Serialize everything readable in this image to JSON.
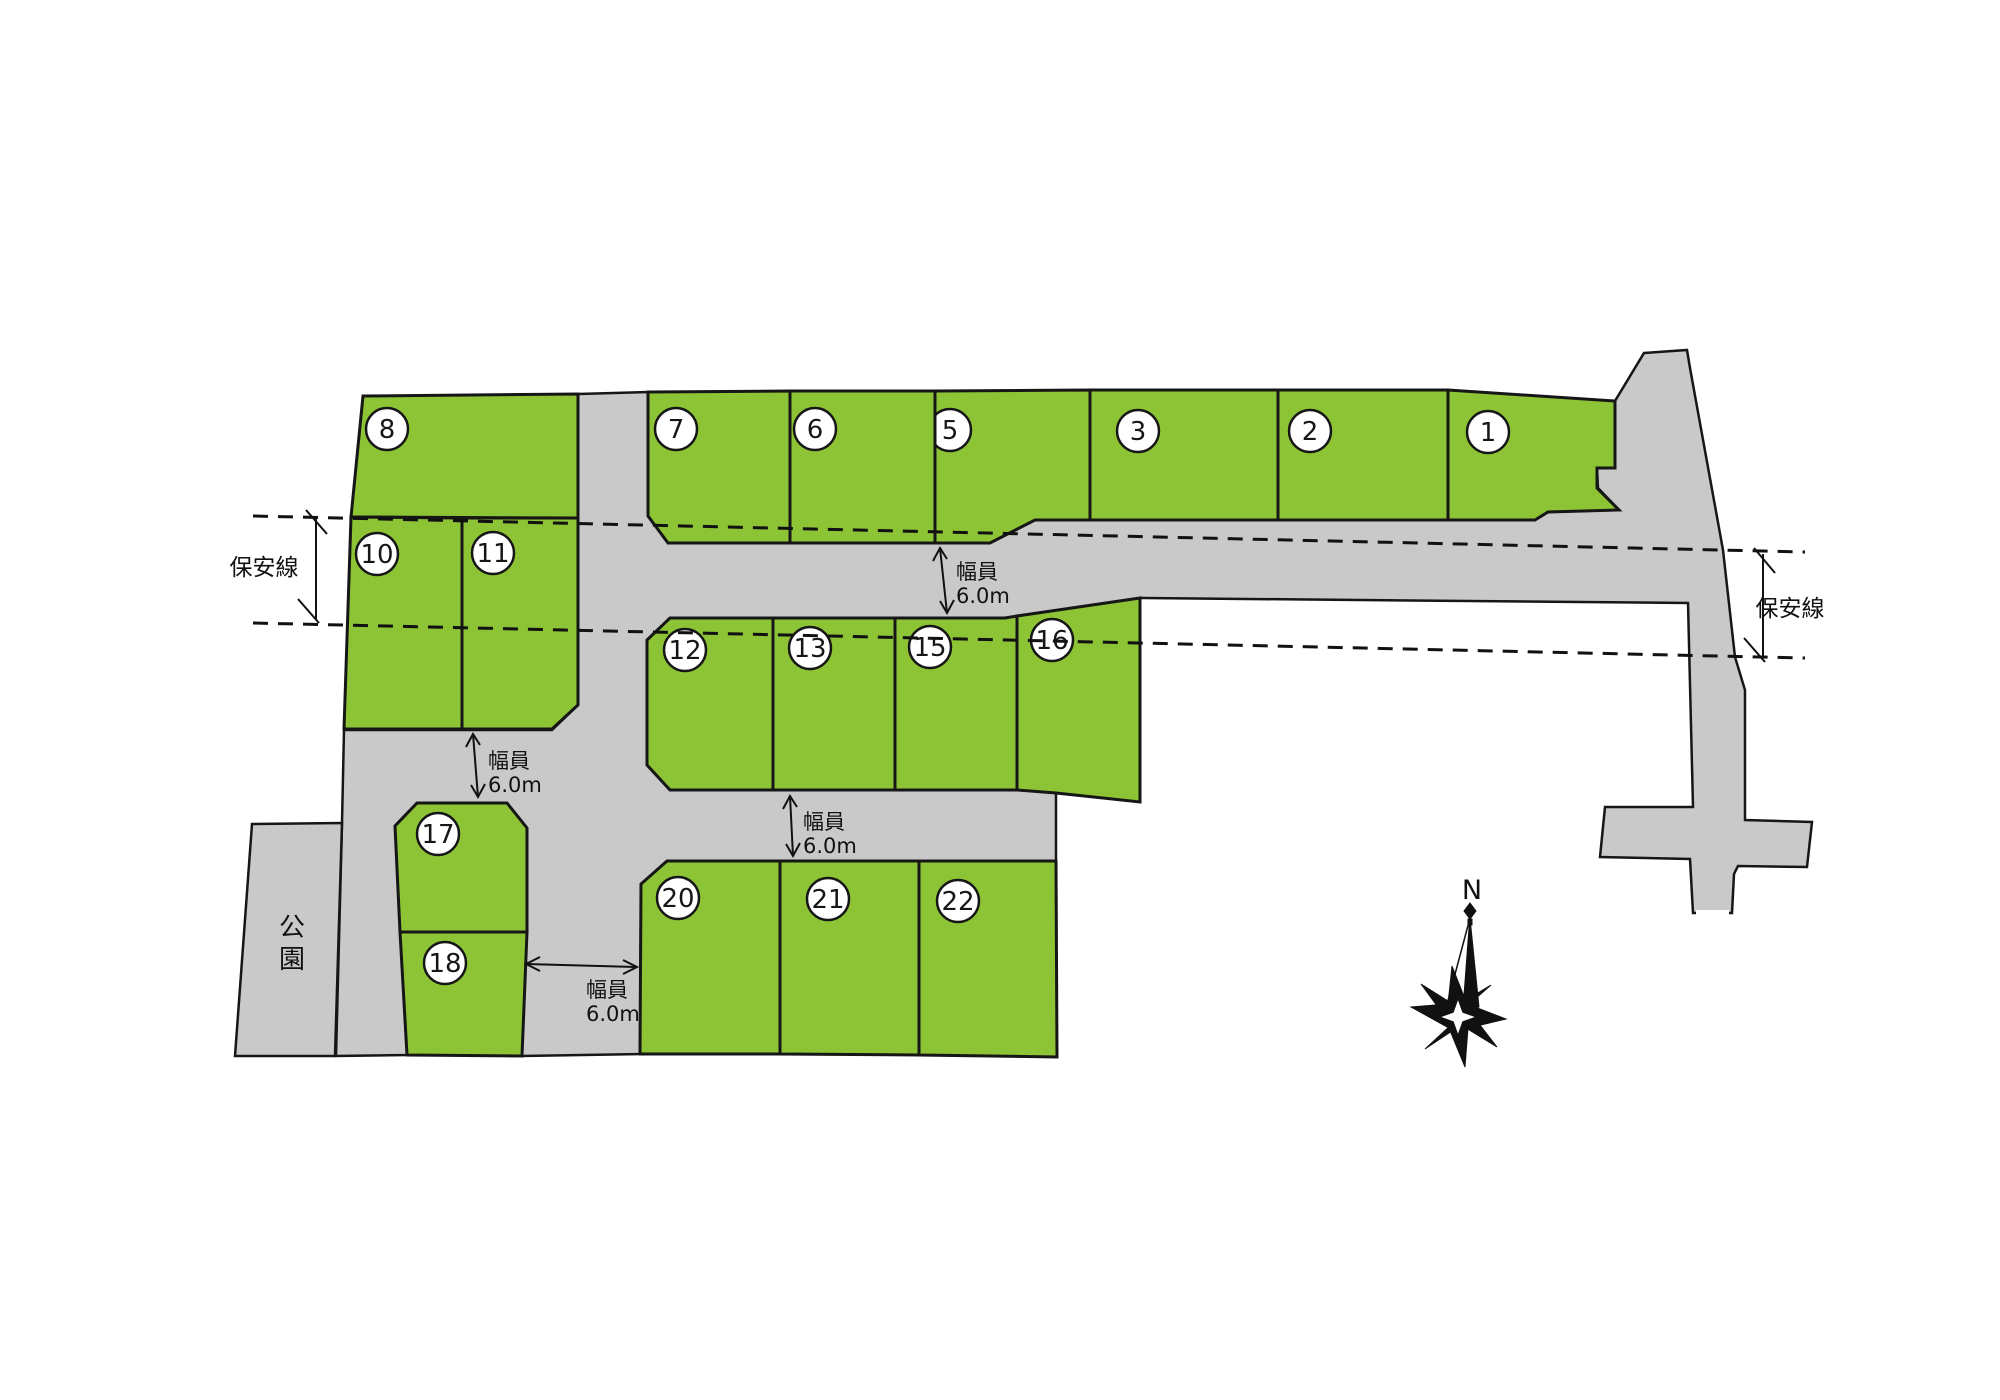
{
  "colors": {
    "lot_fill": "#8cc435",
    "road_fill": "#c9c9c9",
    "outline": "#161616"
  },
  "security_line": {
    "label": "保安線"
  },
  "width_label": {
    "line1": "幅員",
    "line2": "6.0m"
  },
  "park": {
    "label": "公園",
    "chars": [
      "公",
      "園"
    ]
  },
  "compass": {
    "north_label": "N"
  },
  "lots": [
    {
      "no": "1",
      "label_x": 1488,
      "label_y": 432,
      "points": "1448,390 1615,401 1615,468 1597,468 1597,488 1619,510 1548,512 1535,520 1448,520"
    },
    {
      "no": "2",
      "label_x": 1310,
      "label_y": 431,
      "points": "1278,390 1448,390 1448,520 1278,520"
    },
    {
      "no": "3",
      "label_x": 1138,
      "label_y": 431,
      "points": "1090,390 1278,390 1278,520 1090,520"
    },
    {
      "no": "5",
      "label_x": 950,
      "label_y": 430,
      "points": "935,391 1090,390 1090,520 1035,520 990,543 935,543"
    },
    {
      "no": "6",
      "label_x": 815,
      "label_y": 429,
      "points": "790,391 935,391 935,543 790,543"
    },
    {
      "no": "7",
      "label_x": 676,
      "label_y": 429,
      "points": "648,392 790,391 790,543 668,543 648,516"
    },
    {
      "no": "8",
      "label_x": 387,
      "label_y": 429,
      "points": "363,396 578,394 578,518 351,517"
    },
    {
      "no": "10",
      "label_x": 377,
      "label_y": 554,
      "points": "351,517 462,518 462,729 344,729"
    },
    {
      "no": "11",
      "label_x": 493,
      "label_y": 553,
      "points": "462,518 578,518 578,705 552,729 462,729"
    },
    {
      "no": "12",
      "label_x": 685,
      "label_y": 650,
      "points": "670,618 773,618 773,790 670,790 647,765 647,640"
    },
    {
      "no": "13",
      "label_x": 810,
      "label_y": 648,
      "points": "773,618 895,618 895,790 773,790"
    },
    {
      "no": "15",
      "label_x": 930,
      "label_y": 647,
      "points": "895,618 1005,618 1017,616 1017,790 895,790"
    },
    {
      "no": "16",
      "label_x": 1052,
      "label_y": 640,
      "points": "1017,616 1140,598 1140,802 1056,793 1017,790"
    },
    {
      "no": "17",
      "label_x": 438,
      "label_y": 834,
      "points": "417,803 507,803 527,828 527,932 400,932 395,826"
    },
    {
      "no": "18",
      "label_x": 445,
      "label_y": 963,
      "points": "400,932 527,932 522,1056 407,1055"
    },
    {
      "no": "20",
      "label_x": 678,
      "label_y": 898,
      "points": "667,861 780,861 780,1054 640,1054 641,884"
    },
    {
      "no": "21",
      "label_x": 828,
      "label_y": 899,
      "points": "780,861 919,861 919,1055 780,1054"
    },
    {
      "no": "22",
      "label_x": 958,
      "label_y": 901,
      "points": "919,861 1056,861 1057,1057 919,1055"
    }
  ]
}
